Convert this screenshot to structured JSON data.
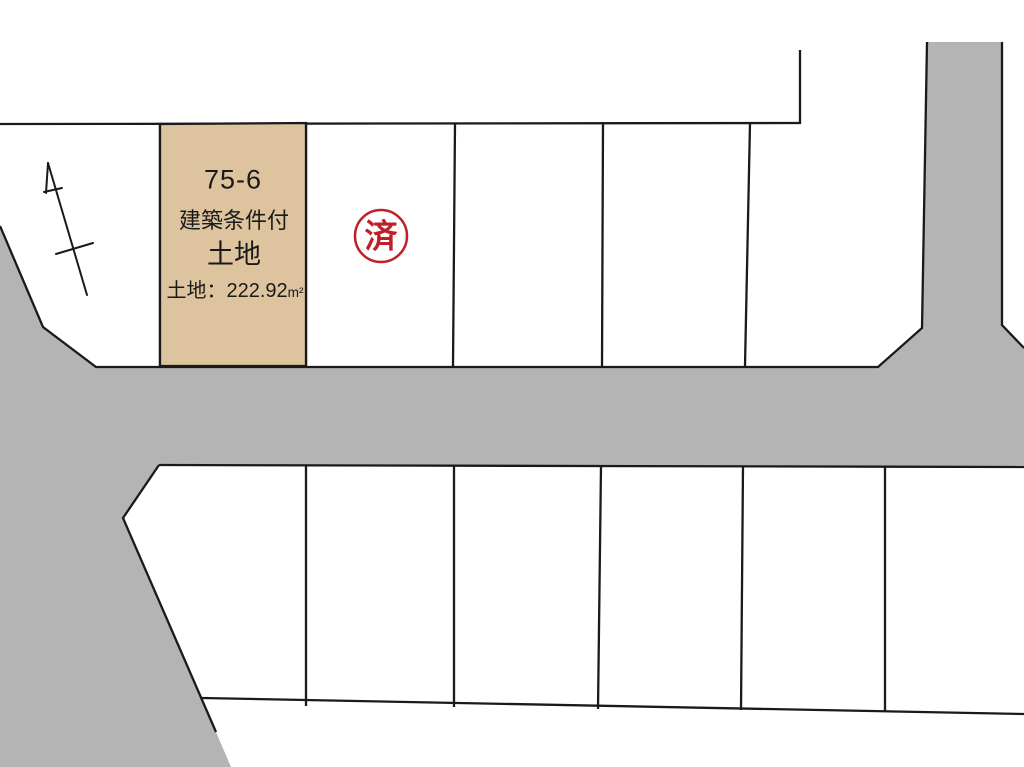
{
  "colors": {
    "road": "#b4b4b4",
    "plot_highlight": "#ddc39e",
    "line": "#1a1a1a",
    "stamp_red": "#bf2027"
  },
  "highlighted_plot": {
    "number": "75-6",
    "condition": "建築条件付",
    "category": "土地",
    "area_label": "土地：222.92",
    "area_unit": "m²"
  },
  "stamp": {
    "label": "済"
  }
}
